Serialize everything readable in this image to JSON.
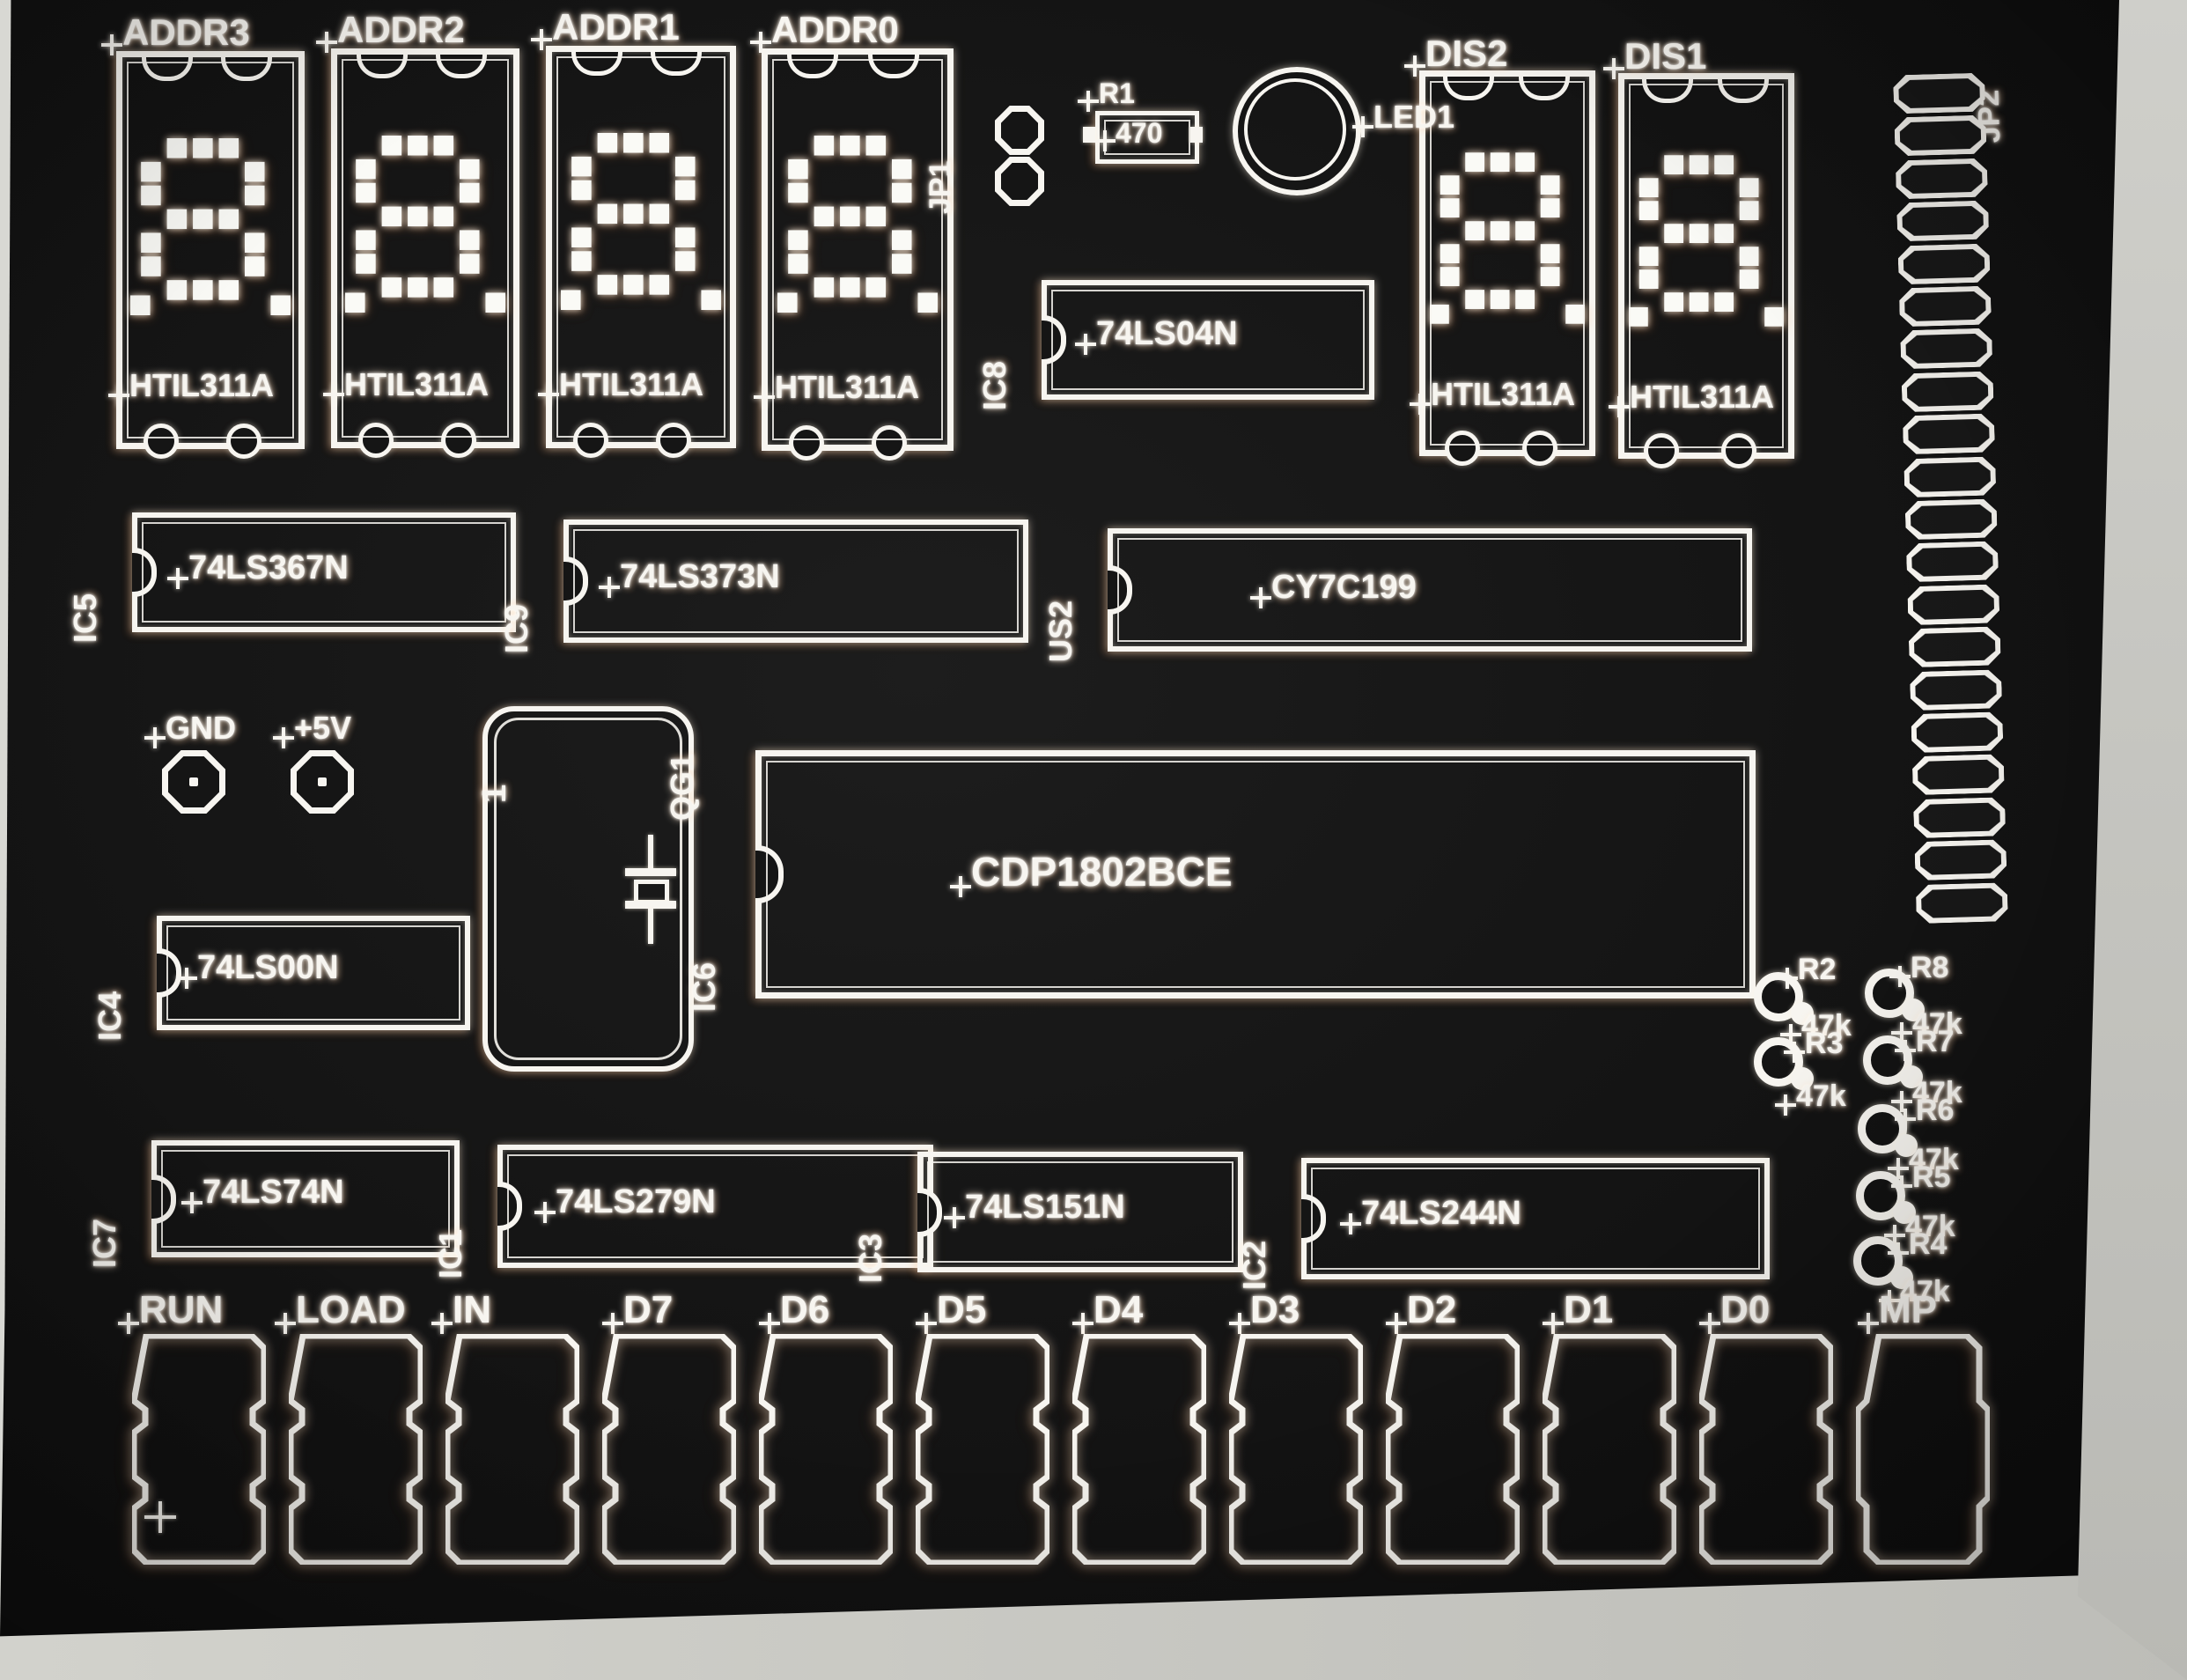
{
  "colors": {
    "canvas": "#151515",
    "silkscreen": "#f7f5f0",
    "bezel": "#c8c7c2"
  },
  "displays": [
    {
      "ref": "ADDR3",
      "part": "HTIL311A",
      "glyph": "8."
    },
    {
      "ref": "ADDR2",
      "part": "HTIL311A",
      "glyph": "8."
    },
    {
      "ref": "ADDR1",
      "part": "HTIL311A",
      "glyph": "8."
    },
    {
      "ref": "ADDR0",
      "part": "HTIL311A",
      "glyph": "8."
    },
    {
      "ref": "DIS2",
      "part": "HTIL311A",
      "glyph": "8."
    },
    {
      "ref": "DIS1",
      "part": "HTIL311A",
      "glyph": "8."
    }
  ],
  "ics": [
    {
      "ref": "IC8",
      "value": "74LS04N"
    },
    {
      "ref": "IC5",
      "value": "74LS367N"
    },
    {
      "ref": "IC9",
      "value": "74LS373N"
    },
    {
      "ref": "US2",
      "value": "CY7C199"
    },
    {
      "ref": "IC4",
      "value": "74LS00N"
    },
    {
      "ref": "IC6",
      "value": "CDP1802BCE"
    },
    {
      "ref": "IC7",
      "value": "74LS74N"
    },
    {
      "ref": "IC1",
      "value": "74LS279N"
    },
    {
      "ref": "IC3",
      "value": "74LS151N"
    },
    {
      "ref": "IC2",
      "value": "74LS244N"
    }
  ],
  "jumpers": {
    "jp1": {
      "ref": "JP1",
      "pins": 2
    },
    "jp2": {
      "ref": "JP2",
      "pins": 20
    }
  },
  "led": {
    "ref": "LED1"
  },
  "resistor_r1": {
    "ref": "R1",
    "value": "470"
  },
  "crystal": {
    "ref": "QG1",
    "pin1": "1"
  },
  "testpoints": {
    "gnd": "GND",
    "plus5v": "+5V"
  },
  "pullups": {
    "left": [
      {
        "ref": "R2",
        "value": "47k"
      },
      {
        "ref": "R3",
        "value": "47k"
      }
    ],
    "right": [
      {
        "ref": "R8",
        "value": "47k"
      },
      {
        "ref": "R7",
        "value": "47k"
      },
      {
        "ref": "R6",
        "value": "47k"
      },
      {
        "ref": "R5",
        "value": "47k"
      },
      {
        "ref": "R4",
        "value": "47k"
      }
    ]
  },
  "switches": [
    {
      "label": "RUN"
    },
    {
      "label": "LOAD"
    },
    {
      "label": "IN"
    },
    {
      "label": "D7"
    },
    {
      "label": "D6"
    },
    {
      "label": "D5"
    },
    {
      "label": "D4"
    },
    {
      "label": "D3"
    },
    {
      "label": "D2"
    },
    {
      "label": "D1"
    },
    {
      "label": "D0"
    },
    {
      "label": "MP"
    }
  ]
}
